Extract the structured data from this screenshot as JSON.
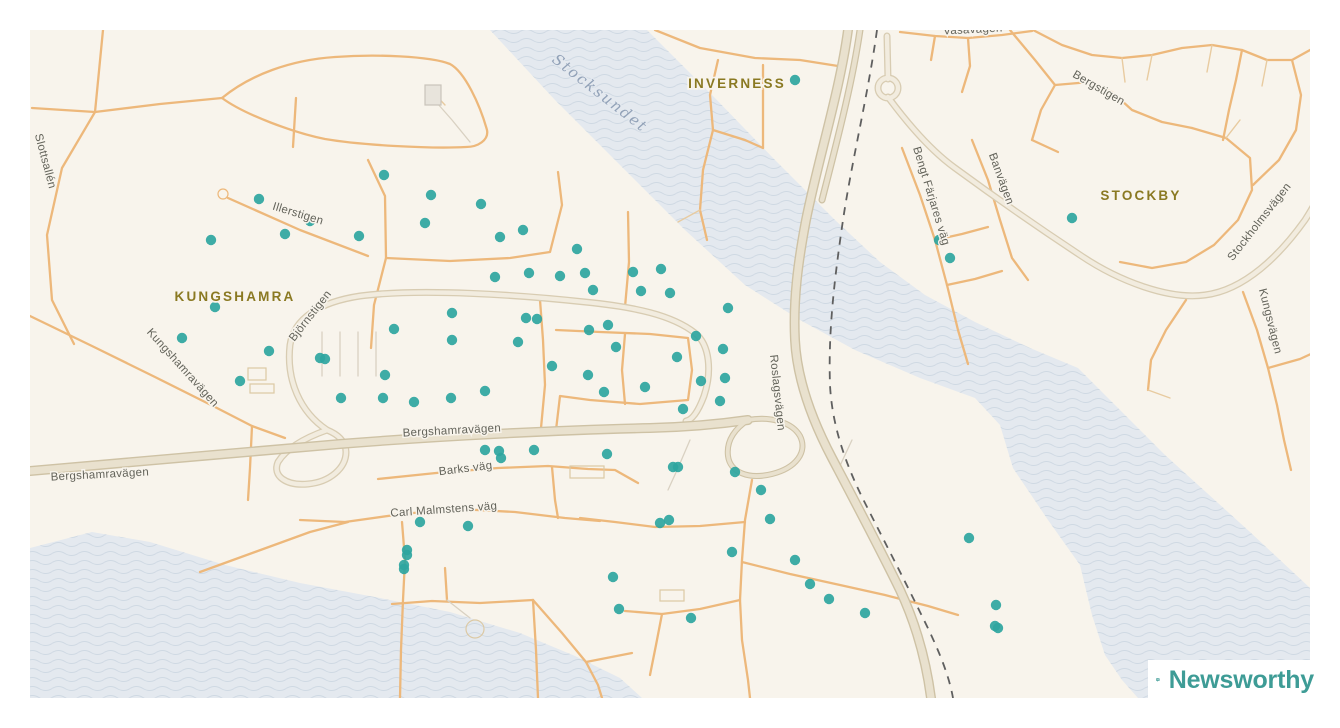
{
  "map": {
    "place_labels": [
      {
        "text": "KUNGSHAMRA"
      },
      {
        "text": "INVERNESS"
      },
      {
        "text": "STOCKBY"
      }
    ],
    "water_labels": [
      {
        "text": "Stocksundet"
      }
    ],
    "street_labels": [
      {
        "text": "Slottsallén"
      },
      {
        "text": "Illerstigen"
      },
      {
        "text": "Kungshamravägen"
      },
      {
        "text": "Björnstigen"
      },
      {
        "text": "Bergshamravägen"
      },
      {
        "text": "Bergshamravägen"
      },
      {
        "text": "Barks väg"
      },
      {
        "text": "Carl Malmstens väg"
      },
      {
        "text": "Roslagsvägen"
      },
      {
        "text": "Bengt Färjares väg"
      },
      {
        "text": "Banvägen"
      },
      {
        "text": "Bergstigen"
      },
      {
        "text": "Stockholmsvägen"
      },
      {
        "text": "Kungsvägen"
      },
      {
        "text": "Vasavägen"
      }
    ],
    "attribution": {
      "brand": "Newsworthy"
    },
    "colors": {
      "land": "#f8f4ec",
      "water": "#e4e9ef",
      "wave_line": "#cfd9e3",
      "minor_road": "#edb87b",
      "light_road_fill": "#f2ecdf",
      "light_road_casing": "#d8ccb2",
      "highway_fill": "#e9e1ce",
      "highway_casing": "#cec2a5",
      "railway": "#5f5f5f",
      "dot": "#2ea59f",
      "brand_teal": "#3e9c96"
    },
    "map_points": [
      [
        795,
        80
      ],
      [
        384,
        175
      ],
      [
        259,
        199
      ],
      [
        431,
        195
      ],
      [
        481,
        204
      ],
      [
        310,
        221
      ],
      [
        285,
        234
      ],
      [
        425,
        223
      ],
      [
        211,
        240
      ],
      [
        359,
        236
      ],
      [
        500,
        237
      ],
      [
        523,
        230
      ],
      [
        577,
        249
      ],
      [
        633,
        272
      ],
      [
        661,
        269
      ],
      [
        529,
        273
      ],
      [
        560,
        276
      ],
      [
        585,
        273
      ],
      [
        593,
        290
      ],
      [
        641,
        291
      ],
      [
        670,
        293
      ],
      [
        495,
        277
      ],
      [
        215,
        307
      ],
      [
        452,
        313
      ],
      [
        526,
        318
      ],
      [
        537,
        319
      ],
      [
        394,
        329
      ],
      [
        452,
        340
      ],
      [
        518,
        342
      ],
      [
        269,
        351
      ],
      [
        320,
        358
      ],
      [
        325,
        359
      ],
      [
        240,
        381
      ],
      [
        385,
        375
      ],
      [
        341,
        398
      ],
      [
        383,
        398
      ],
      [
        414,
        402
      ],
      [
        451,
        398
      ],
      [
        485,
        391
      ],
      [
        608,
        325
      ],
      [
        589,
        330
      ],
      [
        728,
        308
      ],
      [
        696,
        336
      ],
      [
        723,
        349
      ],
      [
        616,
        347
      ],
      [
        677,
        357
      ],
      [
        552,
        366
      ],
      [
        588,
        375
      ],
      [
        701,
        381
      ],
      [
        725,
        378
      ],
      [
        604,
        392
      ],
      [
        645,
        387
      ],
      [
        720,
        401
      ],
      [
        683,
        409
      ],
      [
        182,
        338
      ],
      [
        485,
        450
      ],
      [
        499,
        451
      ],
      [
        501,
        458
      ],
      [
        534,
        450
      ],
      [
        607,
        454
      ],
      [
        673,
        467
      ],
      [
        678,
        467
      ],
      [
        735,
        472
      ],
      [
        761,
        490
      ],
      [
        770,
        519
      ],
      [
        660,
        523
      ],
      [
        669,
        520
      ],
      [
        732,
        552
      ],
      [
        795,
        560
      ],
      [
        810,
        584
      ],
      [
        613,
        577
      ],
      [
        619,
        609
      ],
      [
        691,
        618
      ],
      [
        829,
        599
      ],
      [
        865,
        613
      ],
      [
        969,
        538
      ],
      [
        996,
        605
      ],
      [
        995,
        626
      ],
      [
        998,
        628
      ],
      [
        939,
        240
      ],
      [
        950,
        258
      ],
      [
        1072,
        218
      ],
      [
        420,
        522
      ],
      [
        468,
        526
      ],
      [
        407,
        550
      ],
      [
        407,
        555
      ],
      [
        404,
        565
      ],
      [
        404,
        569
      ]
    ]
  }
}
